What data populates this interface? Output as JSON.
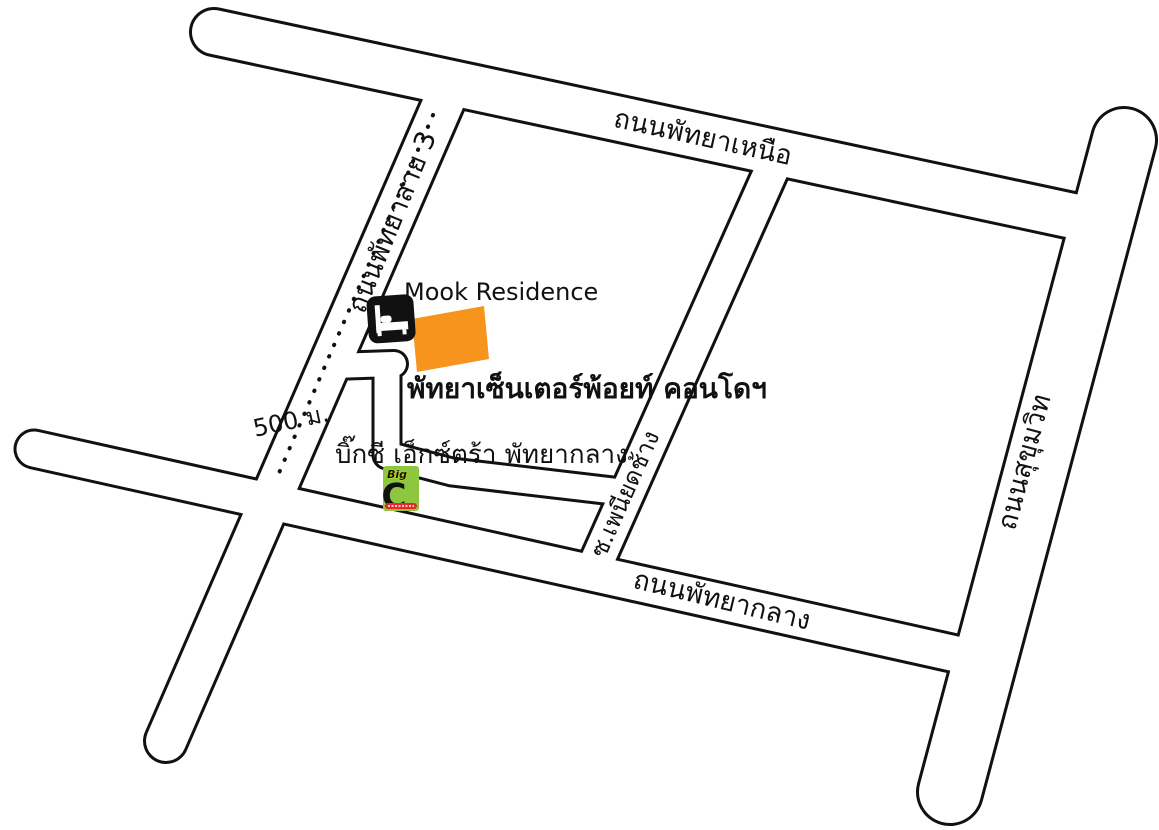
{
  "map": {
    "title": "Mook Residence location map (Pattaya)",
    "background": "#ffffff",
    "line_color": "#111111",
    "road_labels": {
      "north_pattaya_road": "ถนนพัทยาเหนือ",
      "pattaya_3rd_road": "ถนนพัทยาสาย 3",
      "sukhumvit_road": "ถนนสุขุมวิท",
      "central_pattaya_road": "ถนนพัทยากลาง",
      "phaniad_chang_soi": "ซ.เพนียดช้าง"
    },
    "pois": {
      "residence_name": "Mook Residence",
      "condo_name": "พัทยาเซ็นเตอร์พ้อยท์ คอนโดฯ",
      "bigc_name": "บิ๊กซี เอ็กซ์ตร้า พัทยากลาง",
      "distance_label": "500 ม."
    },
    "bigc_logo": {
      "word_big": "Big",
      "letter_c": "C"
    },
    "colors": {
      "condo_building": "#F7941E",
      "bigc_green": "#8DC63F",
      "bigc_red": "#E8262D",
      "bigc_yellow": "#FFF200",
      "icon_black": "#111111"
    }
  }
}
